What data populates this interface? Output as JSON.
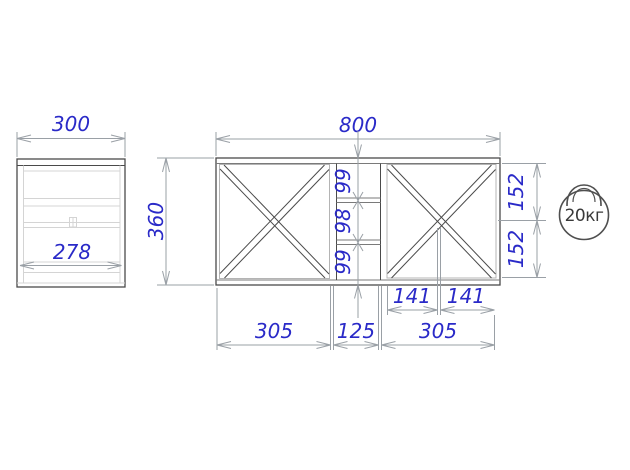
{
  "drawing": {
    "side_view": {
      "top_width": "300",
      "inner_width": "278"
    },
    "front_view": {
      "overall_width": "800",
      "overall_height": "360",
      "center_column_cells": [
        "99",
        "98",
        "99"
      ],
      "right_side_heights": [
        "152",
        "152"
      ],
      "right_section_halves": [
        "141",
        "141"
      ],
      "bottom_widths": [
        "305",
        "125",
        "305"
      ]
    },
    "load_badge": {
      "text": "20кг"
    },
    "colors": {
      "dimension_text": "#2a2ac8",
      "object_line": "#4a4a4a",
      "frame_line": "#b4b4b4",
      "dim_line": "#9aa0a6",
      "light_line": "#d4d4d4",
      "icon_line": "#4f4f4f"
    }
  }
}
